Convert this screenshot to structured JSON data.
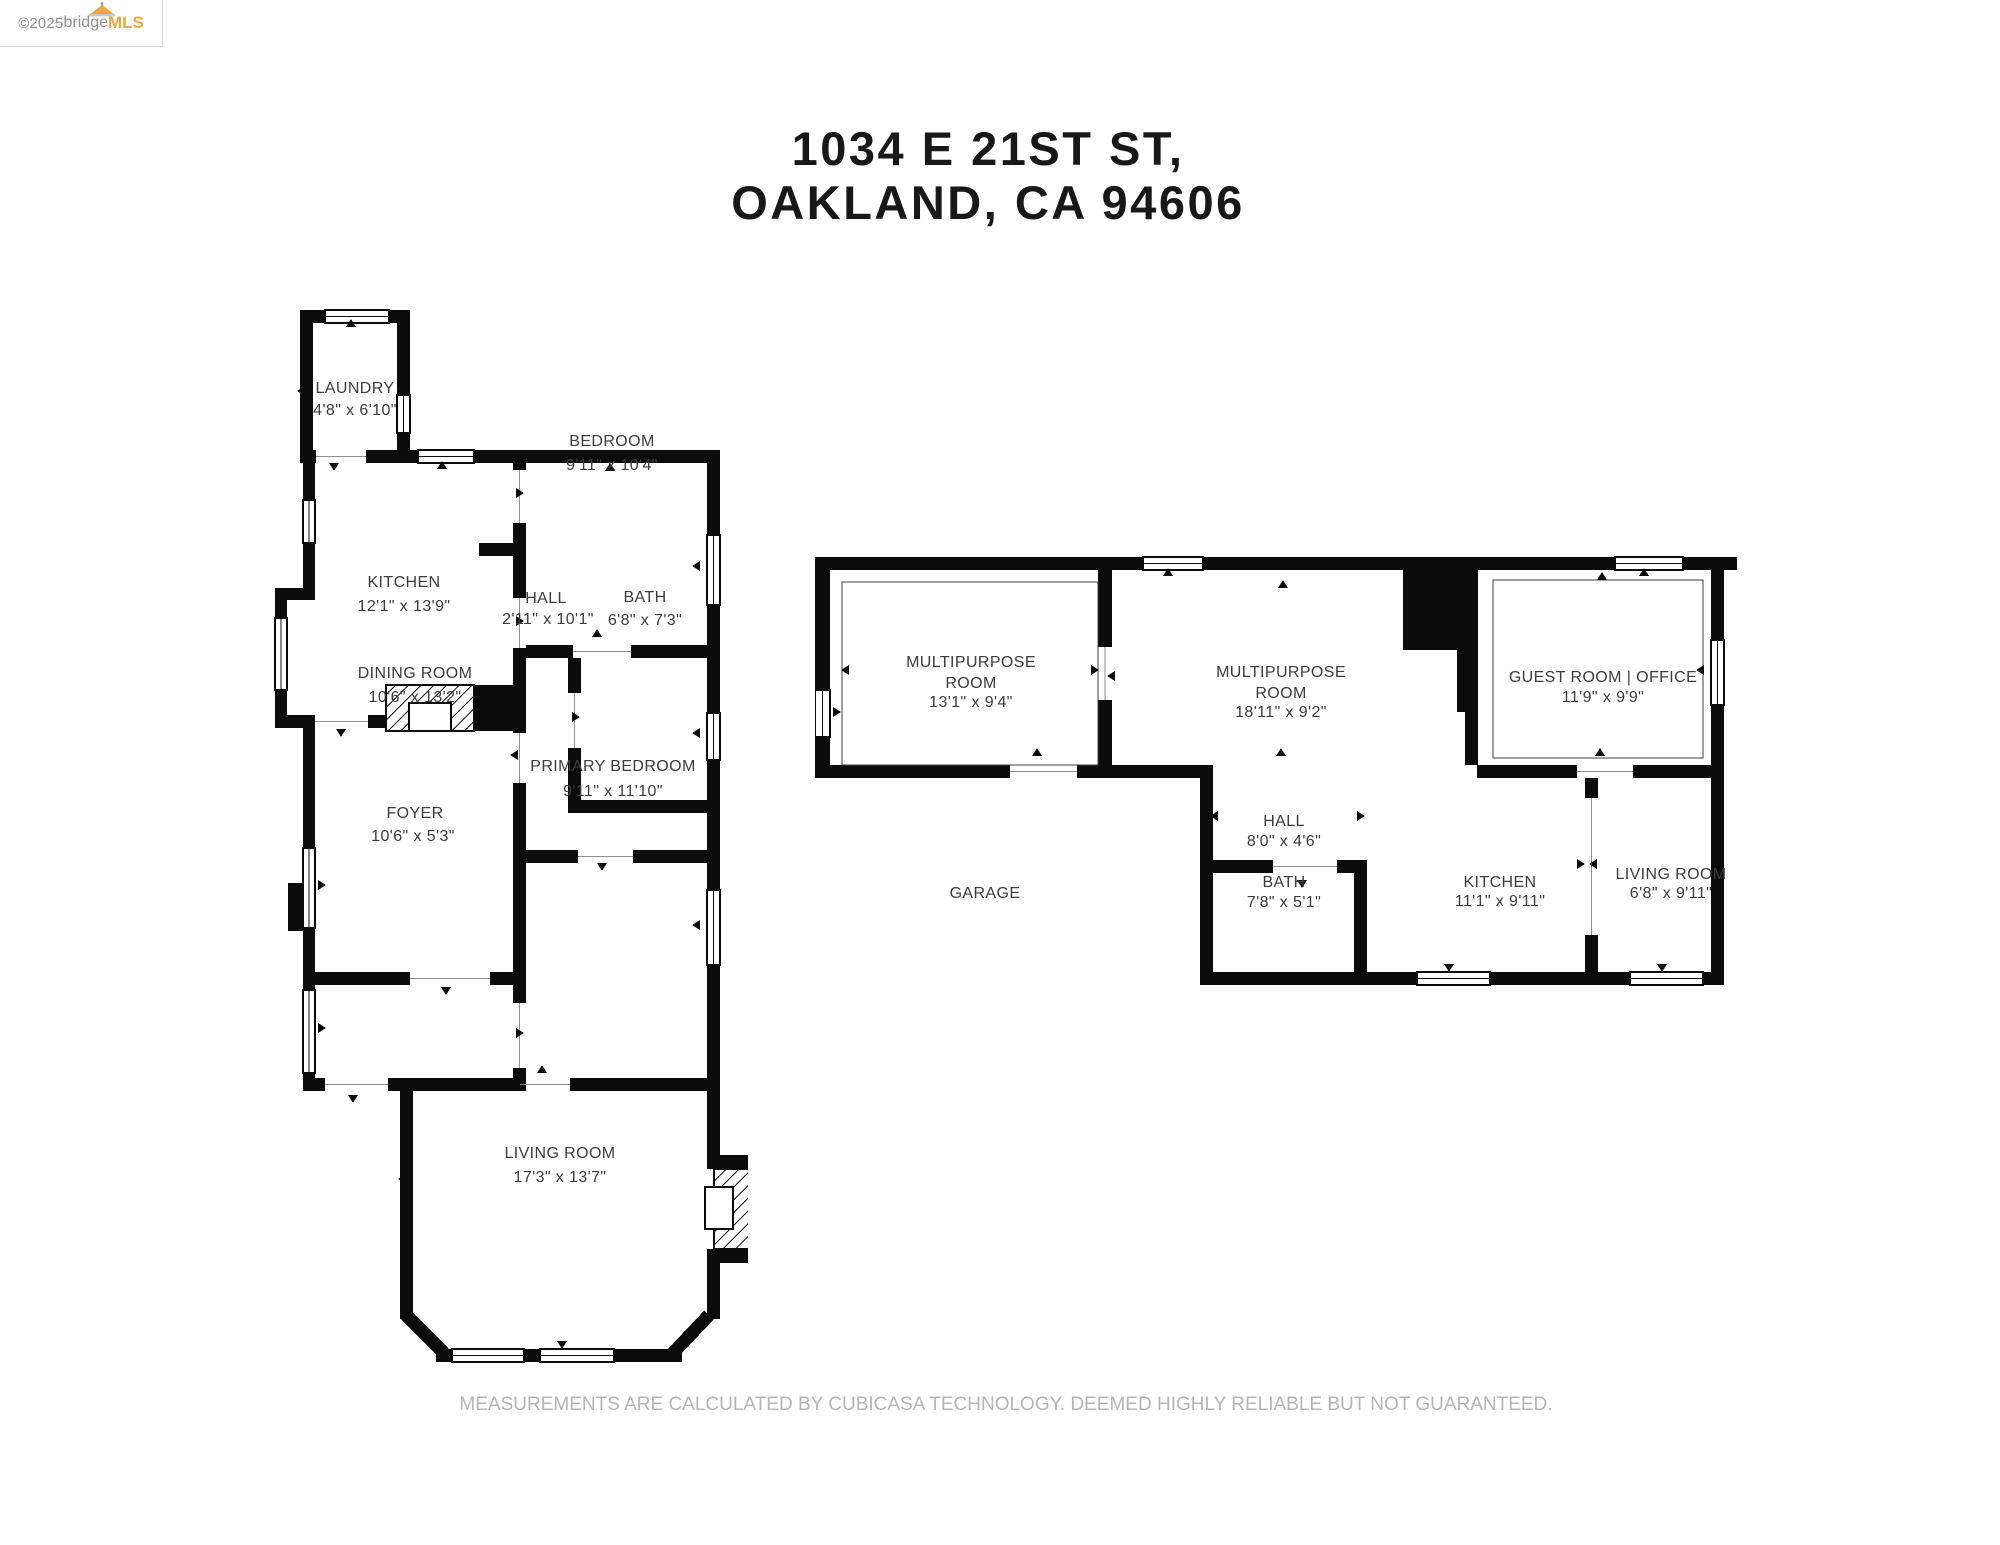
{
  "watermark": {
    "copyright": "©2025 ",
    "brand_gray": "bridge",
    "brand_orange": "MLS"
  },
  "header": {
    "title_line1": "1034 E 21ST ST,",
    "title_line2": "OAKLAND, CA 94606"
  },
  "footer": {
    "disclaimer": "MEASUREMENTS ARE CALCULATED BY CUBICASA TECHNOLOGY. DEEMED HIGHLY RELIABLE BUT NOT GUARANTEED."
  },
  "floors": {
    "left": {
      "rooms": [
        {
          "line1": "LAUNDRY",
          "dims": "4'8\" x 6'10\""
        },
        {
          "line1": "KITCHEN",
          "dims": "12'1\" x 13'9\""
        },
        {
          "line1": "BEDROOM",
          "dims": "9'11\" x 10'4\""
        },
        {
          "line1": "HALL",
          "dims": "2'11\" x 10'1\""
        },
        {
          "line1": "BATH",
          "dims": "6'8\" x 7'3\""
        },
        {
          "line1": "DINING ROOM",
          "dims": "10'6\" x 13'2\""
        },
        {
          "line1": "PRIMARY BEDROOM",
          "dims": "9'11\" x 11'10\""
        },
        {
          "line1": "FOYER",
          "dims": "10'6\" x 5'3\""
        },
        {
          "line1": "LIVING ROOM",
          "dims": "17'3\" x 13'7\""
        }
      ]
    },
    "right": {
      "rooms": [
        {
          "line1": "MULTIPURPOSE",
          "line2": "ROOM",
          "dims": "13'1\" x 9'4\""
        },
        {
          "line1": "MULTIPURPOSE",
          "line2": "ROOM",
          "dims": "18'11\" x 9'2\""
        },
        {
          "line1": "GUEST ROOM | OFFICE",
          "dims": "11'9\" x 9'9\""
        },
        {
          "line1": "HALL",
          "dims": "8'0\" x 4'6\""
        },
        {
          "line1": "BATH",
          "dims": "7'8\" x 5'1\""
        },
        {
          "line1": "KITCHEN",
          "dims": "11'1\" x 9'11\""
        },
        {
          "line1": "LIVING ROOM",
          "dims": "6'8\" x 9'11\""
        },
        {
          "line1": "GARAGE"
        }
      ]
    }
  }
}
